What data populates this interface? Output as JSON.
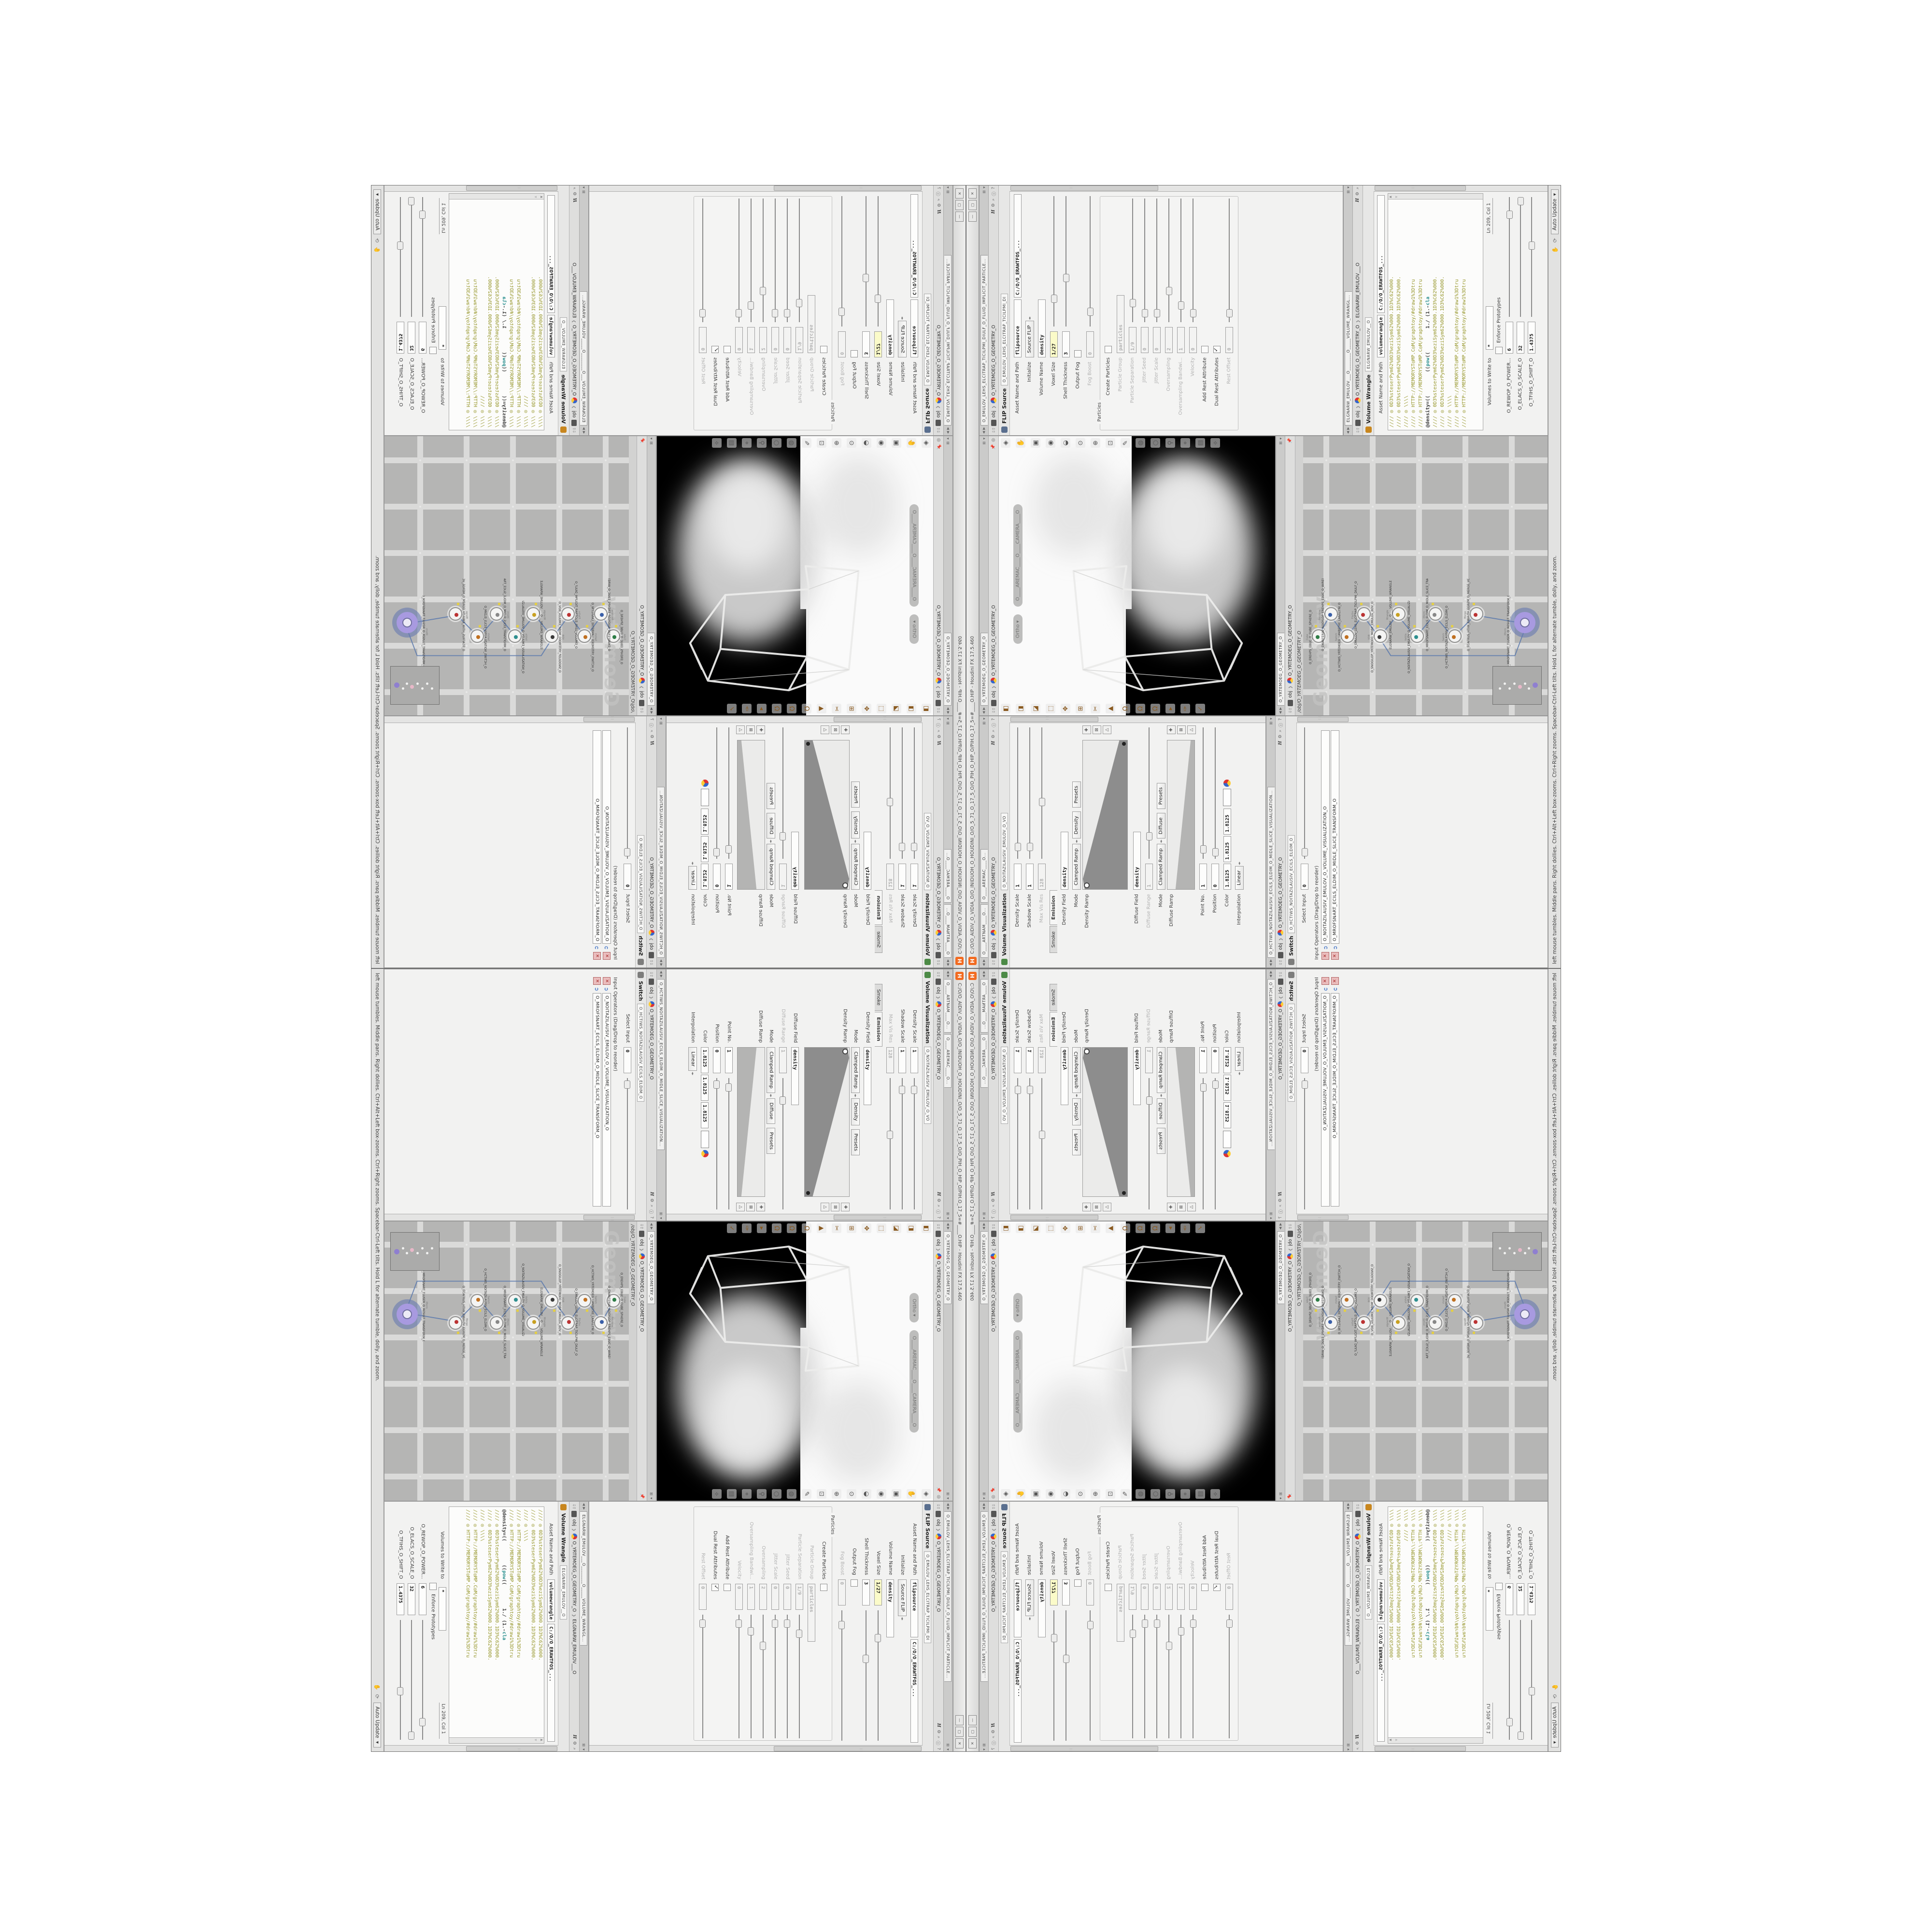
{
  "window": {
    "title": "C:/O/O_AIDIV_O_VIDIA_O/O_INIDUOH_O_HOUDINI_O/O_5_71_O_17_5_O/O_PIH_O_HIP_O/PIH.O_17_5=#____O.HIP - Houdini FX 17.5.460",
    "logo_letter": "H",
    "btn_min": "—",
    "btn_max": "▢",
    "btn_close": "✕"
  },
  "statusbar": {
    "help_text": "left mouse tumbles. Middle pans. Right dollies. Ctrl+Alt+Left box-zooms. Ctrl+Right zooms. Spacebar-Ctrl-Left tilts. Hold L for alternate tumble, dolly, and zoom.",
    "hand_icon": "✋",
    "sync_icon": "⟳",
    "auto_update": "Auto Update",
    "caret": "▾"
  },
  "crumbs": {
    "ctx": "obj",
    "geo": "O_YRTEMOEG_O_GEOMETRY_O",
    "sep": "❯"
  },
  "hdr_icons": {
    "h": "H",
    "gear": "⚙",
    "mag": "⌕",
    "help": "?",
    "info": "ⓘ"
  },
  "panes": {
    "volume_visualization": {
      "tab1": "O____ARTNAM____O...",
      "tab2": "O____AREMAC____O...",
      "node_type": "Volume Visualization",
      "node_tab": "O_NOITAZILAUSIV_EMULOV_O_VO",
      "p_density_scale": "Density Scale",
      "v_density_scale": "1",
      "p_shadow_scale": "Shadow Scale",
      "v_shadow_scale": "1",
      "p_maxvis": "Max Vis Res",
      "v_maxvis": "128",
      "ftab_smoke": "Smoke",
      "ftab_emission": "Emission",
      "p_density_field": "Density Field",
      "v_density_field": "density",
      "p_mode": "Mode",
      "v_mode": "Clamped Ramp",
      "v_mode2": "Density",
      "btn_presets": "Presets",
      "p_density_ramp": "Density Ramp",
      "p_diffuse_field": "Diffuse Field",
      "v_diffuse_field": "density",
      "p_diffuse_range": "Diffuse Range",
      "v_diffuse_range": "1",
      "p_mode2": "Mode",
      "v_mode3": "Clamped Ramp",
      "v_mode4": "Diffuse",
      "p_diffuse_ramp": "Diffuse Ramp",
      "p_pointno": "Point No.",
      "v_pointno": "1",
      "p_position": "Position",
      "v_position": "0",
      "p_color": "Color",
      "v_color1": "1.8125",
      "v_color2": "1.8125",
      "v_color3": "1.8125",
      "p_interp": "Interpolation",
      "v_interp": "Linear",
      "ramp_buttons": [
        {
          "g": "✚",
          "n": "add-point-icon"
        },
        {
          "g": "⊠",
          "n": "delete-point-icon"
        },
        {
          "g": "△",
          "n": "flatten-ramp-icon"
        }
      ]
    },
    "switch": {
      "tab": "O_HCTIWS_NOITAZILAUSIV_ECILS_ELDIM_O_MIDLE_SLICE_VISUALIZATION...",
      "node_type": "Switch",
      "node_tab": "O_HCTIWS_NOITAZILAUSIV_ECILS_ELDIM_O",
      "p_select": "Select Input",
      "v_select": "0",
      "oplist_label": "Input Operators (Drag/Drop to reorder)",
      "op1": "O_NOITAZILAUSIV_EMULOV_O_VOLUME_VISUALIZATION_O",
      "op2": "O_MROFSNART_ECILS_ELDIM_O_MIDLE_SLICE_TRANSFORM_O",
      "x_glyph": "✕",
      "insert_glyph": "➲"
    },
    "viewport": {
      "tab": "O_YRTEMOEG_O_GEOMETRY_O",
      "pill_ortho": "Ortho ▾",
      "pill_camera": "O____AREMAC____O____CAMERA____O",
      "right_tools": [
        {
          "g": "◈",
          "n": "view-tool-icon"
        },
        {
          "g": "✋",
          "n": "pan-tool-icon"
        },
        {
          "g": "▣",
          "n": "frame-icon"
        },
        {
          "g": "◉",
          "n": "pivot-icon"
        },
        {
          "g": "◒",
          "n": "shade-icon"
        },
        {
          "g": "⊙",
          "n": "light-icon"
        },
        {
          "g": "⊕",
          "n": "zoom-icon"
        },
        {
          "g": "⊡",
          "n": "box-zoom-icon"
        },
        {
          "g": "✎",
          "n": "annotate-icon"
        },
        {
          "g": "◍",
          "n": "snapshot-icon"
        },
        {
          "g": "○",
          "n": "dot-icon"
        },
        {
          "g": "⚲",
          "n": "probe-icon"
        },
        {
          "g": "⌖",
          "n": "target-icon"
        },
        {
          "g": "▤",
          "n": "layout-icon"
        },
        {
          "g": "⟡",
          "n": "pose-icon"
        }
      ],
      "left_tools": [
        {
          "g": "◧",
          "n": "handles-icon"
        },
        {
          "g": "◨",
          "n": "shaded-icon"
        },
        {
          "g": "◪",
          "n": "wireframe-icon"
        },
        {
          "g": "⬚",
          "n": "construction-plane-icon"
        },
        {
          "g": "✥",
          "n": "move-icon"
        },
        {
          "g": "⊞",
          "n": "grid-icon"
        },
        {
          "g": "✂",
          "n": "clip-icon"
        },
        {
          "g": "▲",
          "n": "axis-icon"
        },
        {
          "g": "Ω",
          "n": "magnet-grid-icon"
        },
        {
          "g": "Ω",
          "n": "magnet-point-icon"
        },
        {
          "g": "Ω",
          "n": "magnet-prim-icon"
        },
        {
          "g": "▸",
          "n": "play-icon"
        },
        {
          "g": "✑",
          "n": "sculpt-icon"
        },
        {
          "g": "✓",
          "n": "comb-icon"
        }
      ]
    },
    "network": {
      "tab": "O_YRTEMOEG_O_GEOMETRY_O",
      "net_path": "/obj/O_YRTEMOEG_O_GEOMETRY_O",
      "watermark": "Geometry",
      "nodes": [
        {
          "type": "Cube",
          "name": "O_EREHPS_EBUC_O_CUBE_SPHERE_O"
        },
        {
          "type": "PolyWire",
          "name": "O_EMARFERIW_NOGYLOP_EREHPS_EBUC_O_WIREFRAME_O"
        },
        {
          "type": "Switch",
          "name": "O_HCTIWS_YRTEMOEG_LANRETXE_LANRETNI_O"
        },
        {
          "type": "FlipSrc",
          "name": "O_EMULOV_LEHS_ELCITRAP_TICILPMI_DIULF_O"
        },
        {
          "type": "VDB",
          "name": "O_SNOGILOP_YRTEMOEG_MORF_EMULOV_BDV_O"
        },
        {
          "type": "Wrangle",
          "name": "ELGNARW_EMULOV___O____VOLUME_WRANGLE"
        },
        {
          "type": "VolVis",
          "name": "O_NOITAZILAUSIV_EMULOV_O_VOLUME_VISUALIZATION_O"
        },
        {
          "type": "Xform",
          "name": "O_MROFSNART_ECILS_ELDIM_O_MIDLE_SLICE_TRANSFORM_O"
        },
        {
          "type": "Switch",
          "name": "O_HCTIWS_NOITAZILAUSIV_ECILS_ELDIM_O"
        },
        {
          "type": "Merge",
          "name": "O_ECAFRUS_HTIW_EMULOV_EGREM_O_MERGE_VOLUME_WITH_SURFACE_O"
        },
        {
          "type": "Xform",
          "name": "O_MROFSNART_TLUSER_O_RESULT_TRANSFORM_O"
        }
      ]
    },
    "flip": {
      "tab": "O_EMULOV_LEHS_ELCITRAP_TICILPMI_DIULF_O_FLUID_IMPLICIT_PARTICLE...",
      "node_type": "FLIP Source",
      "node_tab": "O_EMULOV_LEHS_ELCITRAP_TICILPMI_DI",
      "p_asset": "Asset Name and Path",
      "v_asset": "flipsource",
      "v_asset_path": "C:/O/O_ERAWTFOS_...",
      "p_init": "Initialize",
      "v_init": "Source FLIP",
      "p_volname": "Volume Name",
      "v_volname": "density",
      "p_voxel": "Voxel Size",
      "v_voxel": "1/27",
      "p_shell": "Shell Thickness",
      "v_shell": "3",
      "p_outfog": "Output Fog",
      "p_fogboost": "Fog Boost",
      "v_fogboost": "0",
      "group_particles": "Particles",
      "p_create": "Create Particles",
      "p_pgroup": "Particle Group",
      "v_pgroup": "particles",
      "p_psep": "Particle Separation",
      "v_psep": "1/9",
      "p_jseed": "Jitter Seed",
      "v_jseed": "0",
      "p_jscale": "Jitter Scale",
      "v_jscale": "0",
      "p_oversamp": "Oversampling",
      "v_oversamp": "2",
      "p_oband": "Oversampling Bandwi...",
      "v_oband": "1",
      "p_vel": "Velocity",
      "v_vel": "0",
      "p_addrest": "Add Rest Attribute",
      "p_dualrest": "Dual Rest Attributes",
      "p_restoff": "Rest Offset",
      "v_restoff": "0"
    },
    "volume_wrangle": {
      "tab": "ELGNARW_EMULOV___O________O_____VOLUME_WRANGL...",
      "crumb_node": "ELGNARW_EMULOV___O",
      "node_type": "Volume Wrangle",
      "node_tab": "ELGNARW_EMULOV__O",
      "p_asset": "Asset Name and Path",
      "v_asset": "volumewrangle",
      "v_asset_path": "C:/O/O_ERAWTFOS_...",
      "code_top": [
        "//// ◎ 0D3%steserPym62%0D3%eziSym62%000.1D3%C62%000.",
        "//// ◎ 0D3%steserPym62%0D3%eziSym62%000.1D3%C62%000.",
        "//// ◎ \\\\\\\\",
        "//// ◎ HTTP://MEMORYST◎MP.C◎M/graphtoy/#draw1%3Dtru",
        "//// ◎ HTTP://MEMORYST◎MP.C◎M/graphtoy/#draw1%3Dtru"
      ],
      "expr_a": "@density=((        ((",
      "expr_pow": "pow",
      "expr_b": "((        1./ (1.-",
      "expr_cla": "cla",
      "code_bottom": [
        "//// ◎ 0D3%steserPym62%0D3%eziSym62%000.1D3%C62%000.",
        "//// ◎ 0D3%steserPym62%0D3%eziSym62%000.1D3%C62%000.",
        "//// ◎ \\\\\\\\",
        "//// ◎ HTTP://MEMORYST◎MP.C◎M/graphtoy/#draw1%3Dtru",
        "//// ◎ HTTP://MEMORYST◎MP.C◎M/graphtoy/#draw1%3Dtru"
      ],
      "p_volumes": "Volumes to Write to",
      "v_volumes": "*",
      "p_enforce": "Enforce Prototypes",
      "cursor_pos": "Ln 209, Col 1",
      "sl1_label": "O_REWOP_O_POWER...",
      "sl1_value": "6",
      "sl2_label": "O_ELACS_O_SCALE_O",
      "sl2_value": "32",
      "sl3_label": "O_TFIHS_O_SHIFT_O",
      "sl3_value": "1.4375"
    }
  }
}
